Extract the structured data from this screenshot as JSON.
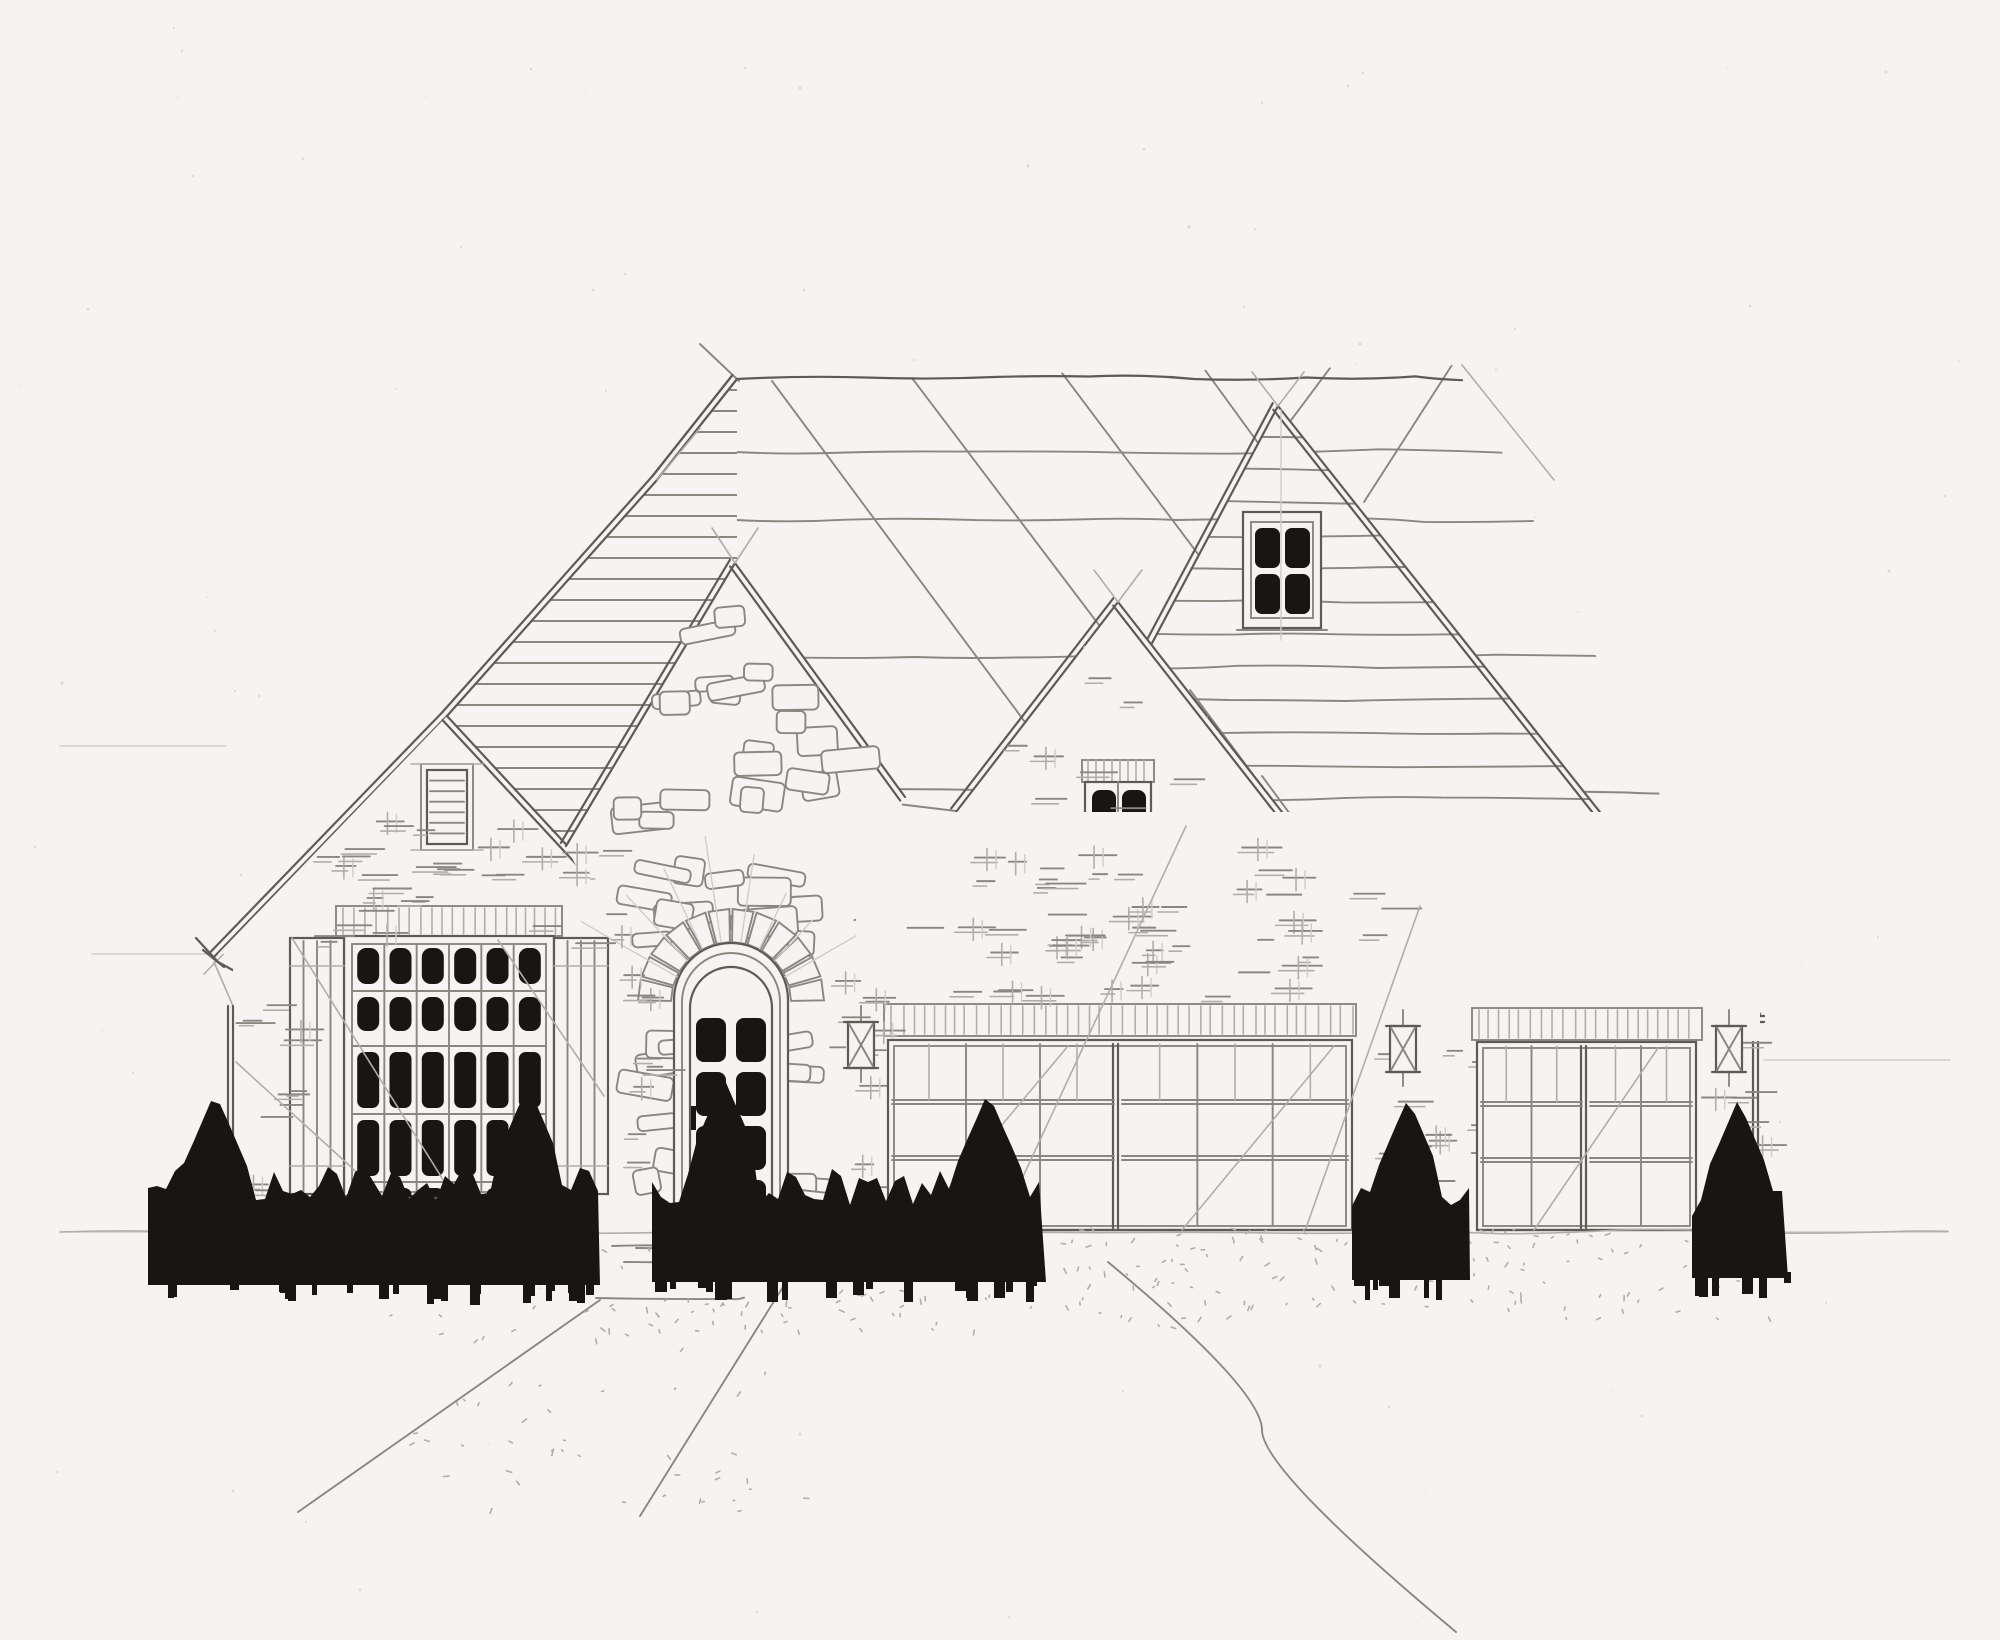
{
  "meta": {
    "title": "Front elevation sketch",
    "description": "Hand-drawn pencil front-elevation of a one-story stone and brick house with three front gables, arched stone entry door, large shuttered picture window, two-car and single-car garages, wall lanterns and dark hedge silhouettes",
    "medium": "pencil on paper",
    "paper_color": "#f5f4f2"
  },
  "palette": {
    "paper": "#f5f4f2",
    "pencil_faint": "#cfcdc8",
    "pencil_light": "#b1aea9",
    "pencil_mid": "#8a8781",
    "pencil_dark": "#5e5b56",
    "pencil_heavy": "#403e3a",
    "ink_black": "#171614"
  },
  "roof": {
    "ridge": [
      737,
      379,
      1462,
      365
    ],
    "hip_tick": [
      700,
      344,
      739,
      381
    ],
    "right_hip": [
      1462,
      365,
      1554,
      480
    ],
    "main_poly": [
      [
        737,
        379
      ],
      [
        1462,
        365
      ],
      [
        1760,
        1012
      ],
      [
        878,
        1012
      ],
      [
        735,
        565
      ]
    ],
    "shingle_wave_y": [
      452,
      520,
      655,
      790,
      918
    ],
    "diagonals": [
      [
        772,
        381,
        1240,
        1012
      ],
      [
        912,
        378,
        1392,
        1012
      ],
      [
        1062,
        373,
        1542,
        1012
      ],
      [
        1205,
        370,
        1662,
        998
      ],
      [
        1330,
        368,
        1242,
        486
      ],
      [
        1452,
        365,
        1364,
        502
      ]
    ],
    "slope_diags_right": [
      [
        1190,
        690,
        1430,
        1012
      ],
      [
        1262,
        776,
        1436,
        1012
      ],
      [
        1332,
        860,
        1444,
        1012
      ]
    ],
    "eave_mid": [
      898,
      804,
      956,
      811
    ],
    "fascia_right": [
      1430,
      1016,
      1764,
      1016
    ]
  },
  "left_roof": {
    "rake_main": [
      [
        737,
        379
      ],
      [
        657,
        480
      ],
      [
        447,
        716
      ],
      [
        213,
        958
      ]
    ],
    "rake_soffit": [
      440,
      732,
      204,
      974
    ],
    "hatch_poly": [
      [
        737,
        381
      ],
      [
        657,
        480
      ],
      [
        447,
        716
      ],
      [
        565,
        847
      ],
      [
        737,
        565
      ]
    ],
    "hatch_step": 21,
    "eave_cap": [
      [
        196,
        938,
        218,
        962
      ],
      [
        218,
        962,
        240,
        974
      ],
      [
        203,
        950,
        224,
        967
      ]
    ]
  },
  "gables": {
    "stone": {
      "apex": [
        735,
        563
      ],
      "rake_left": [
        735,
        563,
        566,
        846
      ],
      "rake_right": [
        735,
        563,
        905,
        797
      ]
    },
    "left_brick": {
      "apex": [
        447,
        716
      ],
      "tri": [
        [
          447,
          716
        ],
        [
          218,
          954
        ],
        [
          658,
          948
        ]
      ],
      "rake_right": [
        447,
        716,
        662,
        948
      ],
      "vent": {
        "frame": [
          427,
          770,
          40,
          74
        ],
        "slats": 6
      }
    },
    "right_brick": {
      "apex": [
        1118,
        602
      ],
      "tri": [
        [
          1118,
          602
        ],
        [
          956,
          812
        ],
        [
          1282,
          812
        ]
      ],
      "window": {
        "band": [
          1082,
          760,
          72,
          22
        ],
        "frame": [
          1085,
          782,
          66,
          114
        ],
        "pane_w": 24,
        "pane_h": 44,
        "sill": [
          1078,
          898,
          78,
          5
        ]
      }
    },
    "right_siding": {
      "apex": [
        1278,
        406
      ],
      "tri": [
        [
          1278,
          406
        ],
        [
          955,
          1014
        ],
        [
          1760,
          1014
        ]
      ],
      "siding_step": 33,
      "window": {
        "frame": [
          1243,
          512,
          78,
          116
        ],
        "pane_w": 25,
        "pane_h": 40,
        "sill": [
          1237,
          630,
          90,
          5
        ]
      }
    }
  },
  "left_wing": {
    "corner_x": 233,
    "corner_top": 1006,
    "base_y": 1232,
    "picture_window": {
      "band": [
        336,
        906,
        226,
        30
      ],
      "frame": [
        344,
        936,
        210,
        260
      ],
      "glass": [
        352,
        944,
        194,
        248
      ],
      "cols": 6,
      "rows": [
        [
          948,
          36
        ],
        [
          997,
          34
        ],
        [
          1052,
          56
        ],
        [
          1120,
          56
        ],
        [
          1188,
          42
        ]
      ],
      "pane_w": 22,
      "shutters": [
        [
          290,
          938,
          54,
          256
        ],
        [
          554,
          938,
          54,
          256
        ]
      ],
      "sill": [
        334,
        1198,
        230,
        6
      ]
    }
  },
  "entry": {
    "opening": [
      674,
      1000,
      788,
      1238
    ],
    "arch_center": [
      731,
      1002
    ],
    "arch_r_inner": 60,
    "arch_r_outer": 93,
    "voussoir_step_deg": 15,
    "door_leaf": [
      690,
      1008,
      772,
      1228
    ],
    "pane_cols": [
      696,
      736
    ],
    "pane_rows": [
      1018,
      1072,
      1126,
      1180
    ],
    "pane_w": 30,
    "pane_h": 44,
    "handle": [
      694,
      1118
    ],
    "steps": [
      [
        636,
        1248,
        824,
        1250
      ],
      [
        624,
        1262,
        836,
        1265
      ]
    ],
    "sunburst_rays": 8
  },
  "garages": {
    "wide": {
      "band": [
        884,
        1004,
        472,
        32
      ],
      "open": [
        888,
        1040,
        464,
        190
      ],
      "mullion": 1118,
      "halves": [
        [
          892,
          1044,
          222,
          182
        ],
        [
          1122,
          1044,
          226,
          182
        ]
      ],
      "cols": 3,
      "rails": [
        1100,
        1156
      ]
    },
    "single": {
      "band": [
        1472,
        1008,
        230,
        32
      ],
      "open": [
        1477,
        1042,
        219,
        188
      ],
      "mullion": 1586,
      "halves": [
        [
          1481,
          1046,
          101,
          180
        ],
        [
          1590,
          1046,
          102,
          180
        ]
      ],
      "cols": 2,
      "rails": [
        1102,
        1158
      ]
    },
    "right_corner_x": 1758
  },
  "lanterns": [
    [
      848,
      1022
    ],
    [
      1390,
      1026
    ],
    [
      1716,
      1026
    ]
  ],
  "shrubs": [
    {
      "x0": 148,
      "x1": 600,
      "base": 1285,
      "top": 1185,
      "spikes": [
        [
          215,
          1092
        ],
        [
          330,
          1162
        ],
        [
          528,
          1085
        ]
      ]
    },
    {
      "x0": 652,
      "x1": 1046,
      "base": 1282,
      "top": 1188,
      "spikes": [
        [
          724,
          1078
        ],
        [
          988,
          1092
        ]
      ]
    },
    {
      "x0": 1352,
      "x1": 1470,
      "base": 1280,
      "top": 1198,
      "spikes": [
        [
          1408,
          1098
        ]
      ]
    },
    {
      "x0": 1692,
      "x1": 1788,
      "base": 1278,
      "top": 1202,
      "spikes": [
        [
          1738,
          1100
        ]
      ]
    }
  ],
  "ground": {
    "baseline": [
      60,
      1232,
      1948
    ],
    "stoop": [
      [
        612,
        1246,
        806,
        1246
      ],
      [
        596,
        1298,
        744,
        1300
      ]
    ],
    "walkway": [
      [
        600,
        1300,
        298,
        1512
      ],
      [
        806,
        1250,
        640,
        1516
      ]
    ],
    "driveway_edge": [
      [
        1108,
        1262
      ],
      [
        1262,
        1430
      ],
      [
        1456,
        1632
      ]
    ],
    "stipple_regions": [
      [
        600,
        1238,
        620,
        95,
        110
      ],
      [
        1230,
        1238,
        560,
        80,
        70
      ],
      [
        380,
        1300,
        430,
        215,
        55
      ],
      [
        870,
        1228,
        900,
        18,
        40
      ]
    ]
  },
  "construction": {
    "guides_h": [
      [
        60,
        746,
        226
      ],
      [
        92,
        954,
        212
      ],
      [
        1764,
        1060,
        1950
      ],
      [
        60,
        1232,
        232
      ],
      [
        1760,
        1232,
        1948
      ]
    ],
    "guides_v": [
      [
        729,
        585,
        938
      ],
      [
        1281,
        412,
        508
      ],
      [
        1118,
        608,
        758
      ],
      [
        446,
        718,
        768
      ]
    ],
    "strokes": [
      [
        292,
        938,
        452,
        1194
      ],
      [
        498,
        940,
        604,
        1096
      ],
      [
        1068,
        1046,
        914,
        1230
      ],
      [
        1334,
        1046,
        1182,
        1230
      ],
      [
        1658,
        1048,
        1534,
        1230
      ],
      [
        1186,
        826,
        1000,
        1226
      ],
      [
        1420,
        906,
        1306,
        1228
      ],
      [
        236,
        1062,
        420,
        1230
      ]
    ]
  },
  "brick_regions": [
    {
      "rect": [
        250,
        845,
        370,
        58
      ],
      "n": 16
    },
    {
      "rect": [
        236,
        1000,
        62,
        225
      ],
      "n": 14
    },
    {
      "rect": [
        612,
        950,
        44,
        240
      ],
      "n": 9
    },
    {
      "rect": [
        822,
        940,
        56,
        280
      ],
      "n": 10
    },
    {
      "clip": "left_brick",
      "rect": [
        230,
        718,
        430,
        230
      ],
      "n": 26
    },
    {
      "clip": "right_brick",
      "rect": [
        960,
        606,
        322,
        206
      ],
      "n": 22
    },
    {
      "rect": [
        960,
        814,
        322,
        184
      ],
      "n": 20
    },
    {
      "rect": [
        862,
        826,
        556,
        172
      ],
      "n": 34
    },
    {
      "rect": [
        1354,
        1040,
        120,
        188
      ],
      "n": 18
    },
    {
      "rect": [
        1700,
        1042,
        58,
        188
      ],
      "n": 12
    }
  ],
  "stone_regions": [
    {
      "poly": [
        [
          735,
          575
        ],
        [
          588,
          838
        ],
        [
          880,
          792
        ]
      ],
      "n": 22
    },
    {
      "rect": [
        642,
        842,
        178,
        156
      ],
      "n": 14,
      "avoid_arch": true
    },
    {
      "rect": [
        644,
        1002,
        30,
        226
      ],
      "n": 7
    },
    {
      "rect": [
        788,
        1002,
        30,
        226
      ],
      "n": 7
    }
  ]
}
